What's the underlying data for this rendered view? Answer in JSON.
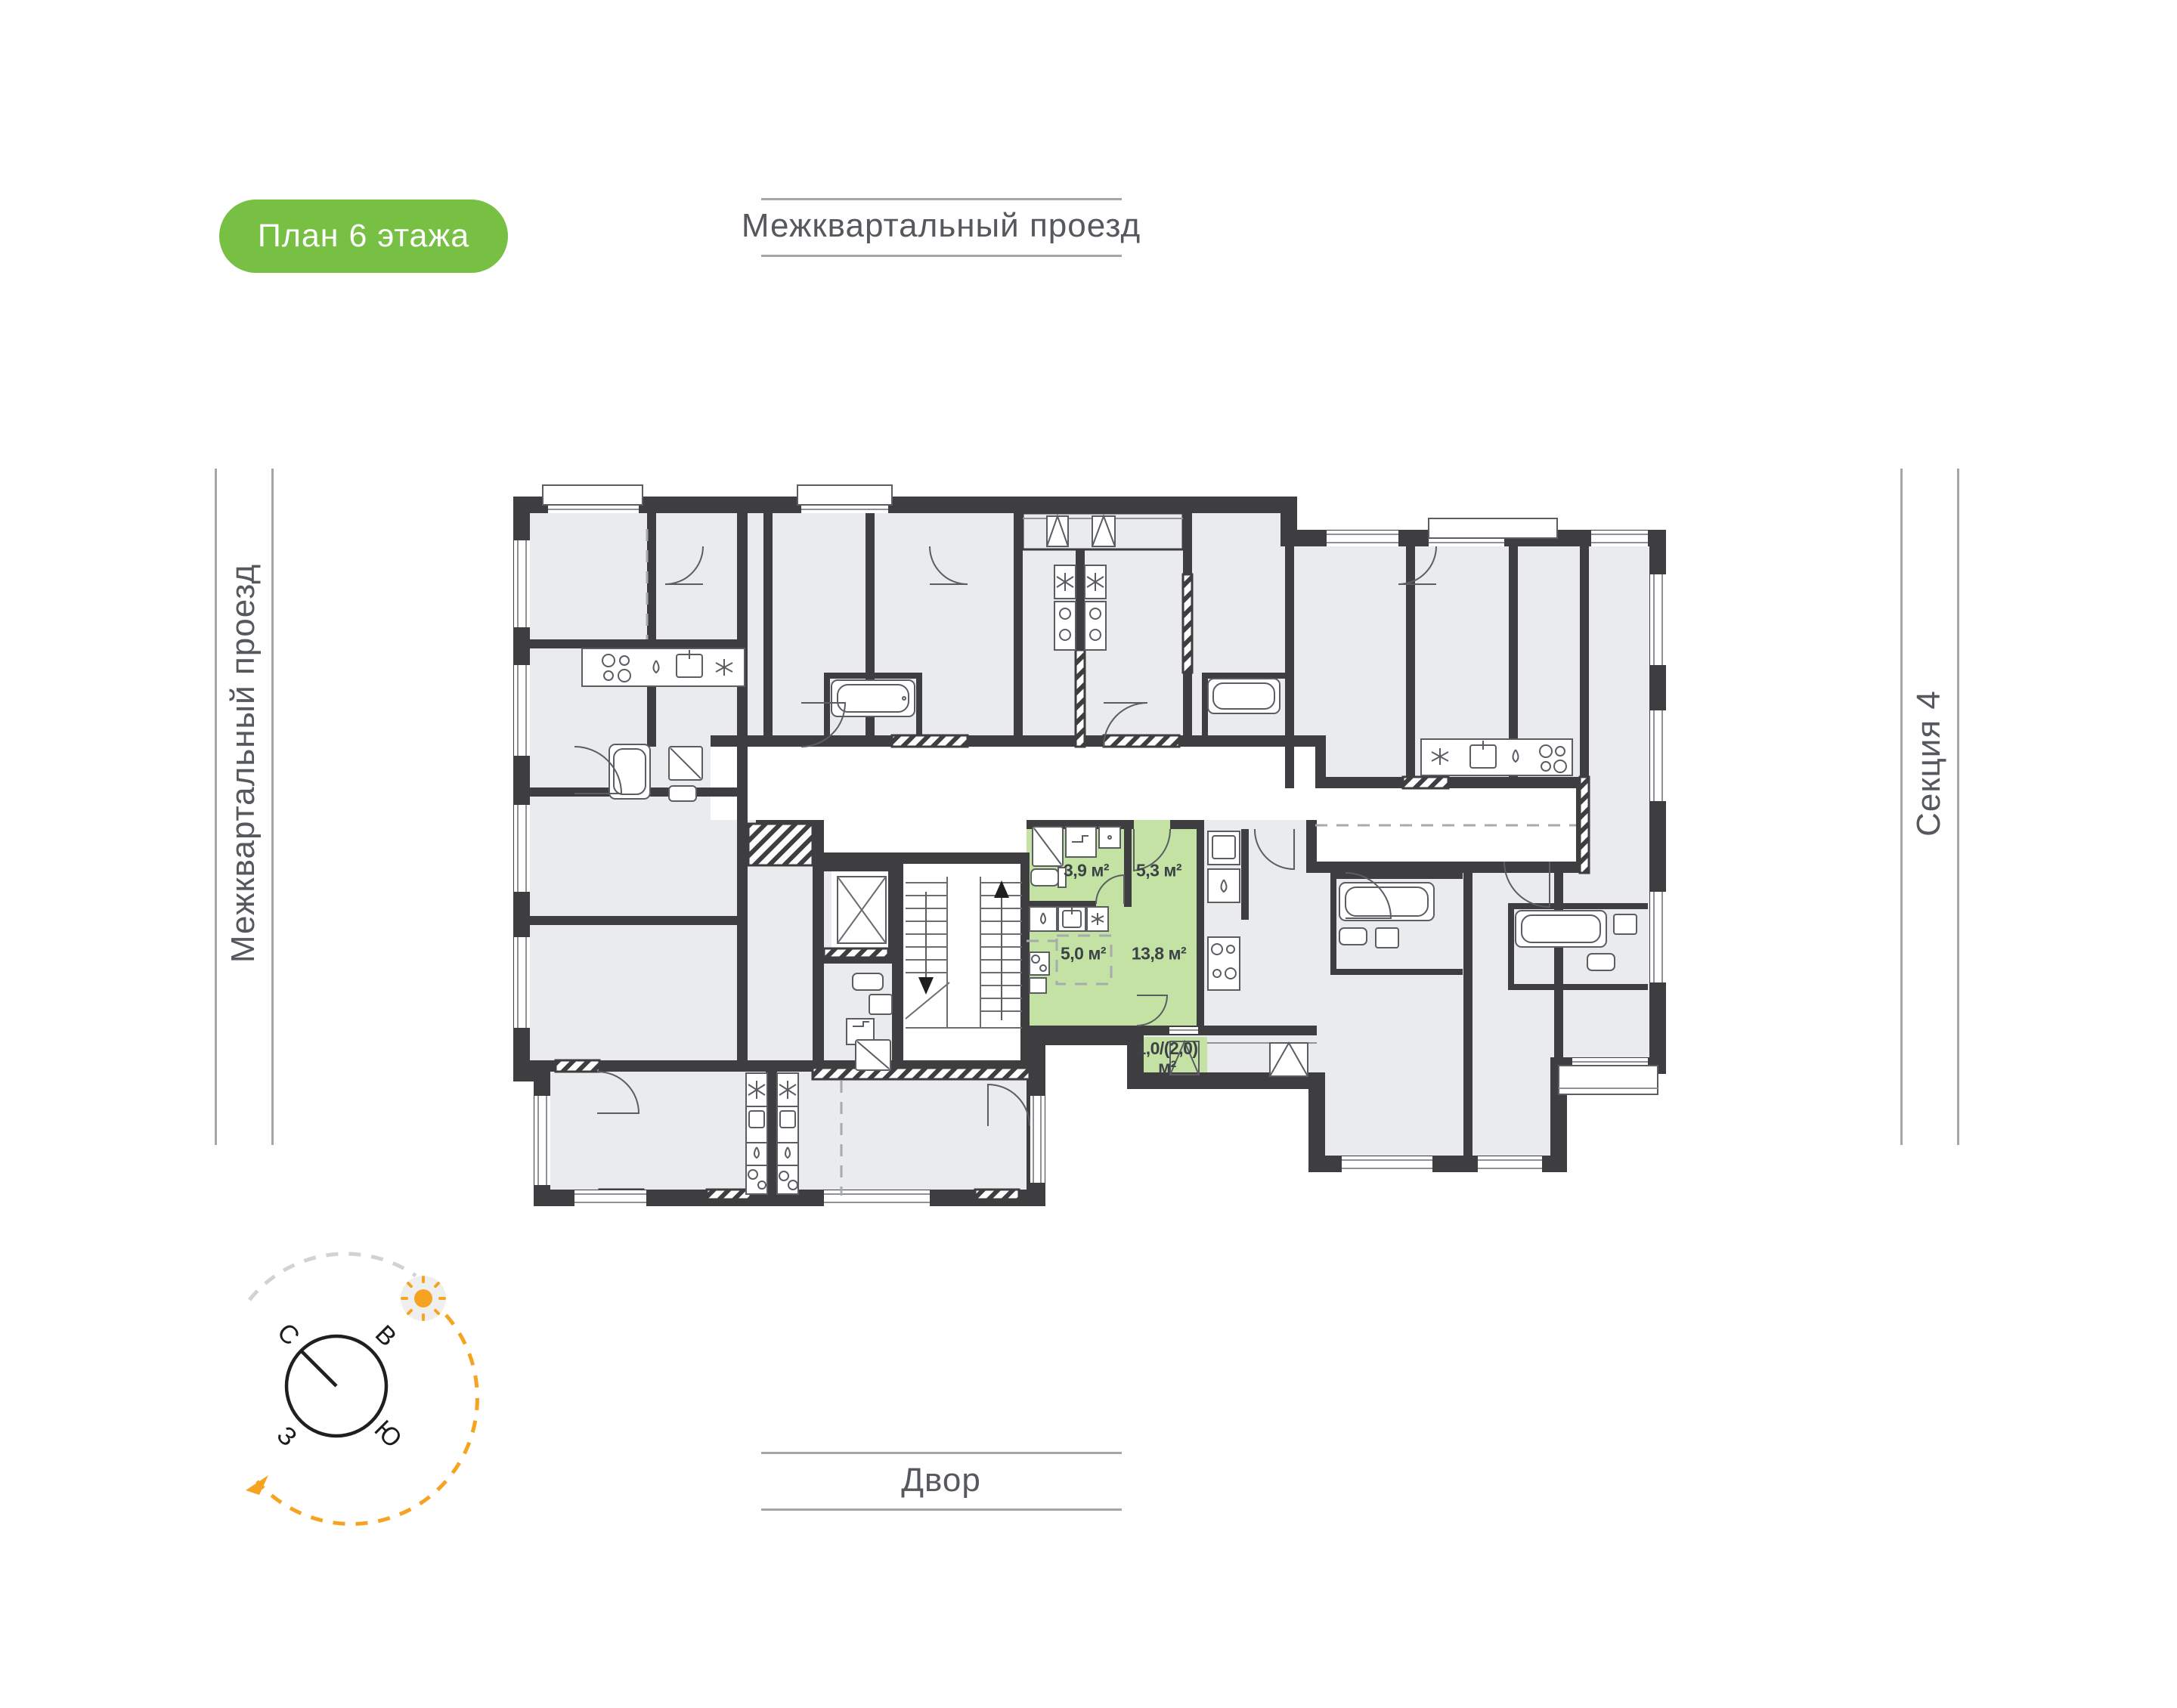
{
  "badge": {
    "label": "План 6 этажа"
  },
  "roads": {
    "top": "Межквартальный проезд",
    "left": "Межквартальный проезд",
    "bottom": "Двор"
  },
  "section": {
    "label": "Секция 4"
  },
  "apartment": {
    "highlighted": true,
    "rooms": [
      {
        "name": "bathroom",
        "area": "3,9 м²"
      },
      {
        "name": "hallway",
        "area": "5,3 м²"
      },
      {
        "name": "kitchen-zone",
        "area": "5,0 м²"
      },
      {
        "name": "living-room",
        "area": "13,8 м²"
      },
      {
        "name": "balcony",
        "area_line1": "1,0/(2,0)",
        "area_line2": "м²"
      }
    ]
  },
  "compass": {
    "north": "С",
    "east": "В",
    "south": "Ю",
    "west": "З"
  },
  "colors": {
    "accent_green": "#77C044",
    "plan_green": "#C4E2A3",
    "wall": "#3E3E40",
    "room_fill": "#EAEBEC",
    "orange": "#F5A321",
    "rule_gray": "#A6A6A6"
  }
}
